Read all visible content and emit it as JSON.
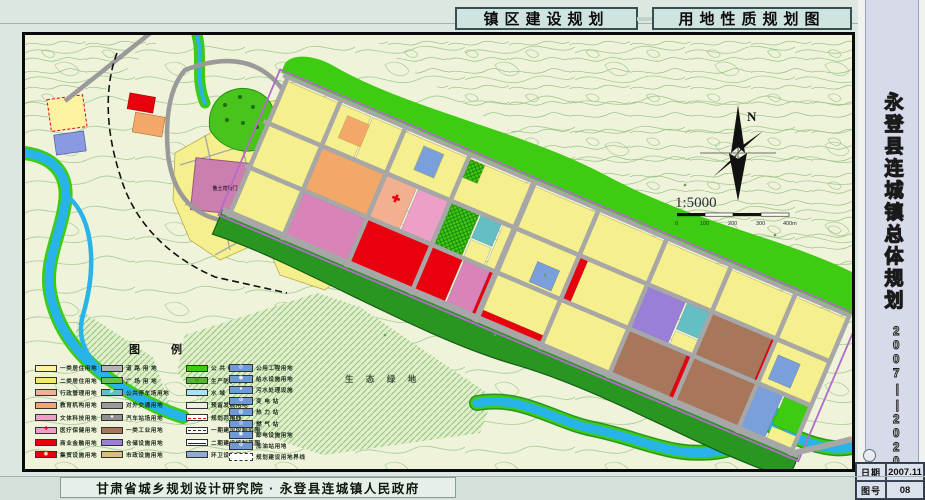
{
  "header": {
    "box1": "镇区建设规划",
    "box2": "用地性质规划图"
  },
  "sidebar": {
    "title": "永登县连城镇总体规划",
    "period": "2007∣∣2020"
  },
  "infobox": {
    "date_label": "日期",
    "date_value": "2007.11",
    "sheet_label": "图号",
    "sheet_value": "08"
  },
  "footer": {
    "credit": "甘肃省城乡规划设计研究院 · 永登县连城镇人民政府"
  },
  "map": {
    "labels": {
      "eco": "生 态 绿 地",
      "heritage": "鲁土司衙门"
    },
    "compass_n": "N",
    "scale_ratio": "1:5000",
    "scale_ticks": [
      "0",
      "100",
      "200",
      "300",
      "400m"
    ]
  },
  "legend": {
    "title": "图  例",
    "columns": [
      {
        "items": [
          {
            "label": "一类居住用地",
            "color": "#fdf3a0"
          },
          {
            "label": "二类居住用地",
            "color": "#f5e96a"
          },
          {
            "label": "行政管理用地",
            "color": "#f2b090"
          },
          {
            "label": "教育机构用地",
            "color": "#f3a869"
          },
          {
            "label": "文体科技用地",
            "color": "#ee9fc8"
          },
          {
            "label": "医疗保健用地",
            "color": "#ee9fc8",
            "sym": "✚",
            "symColor": "#e8000e"
          },
          {
            "label": "商业金融用地",
            "color": "#e8000e"
          },
          {
            "label": "集贸设施用地",
            "color": "#e8000e",
            "sym": "◉",
            "symColor": "#ffffff"
          }
        ]
      },
      {
        "items": [
          {
            "label": "道 路 用 地",
            "color": "#b4b4b4"
          },
          {
            "label": "广 场 用 地",
            "color": "#6abf4b"
          },
          {
            "label": "公共停车场用地",
            "color": "#63bfc4",
            "sym": "P",
            "symColor": "#ffffff"
          },
          {
            "label": "对外交通用地",
            "color": "#9a9a9a"
          },
          {
            "label": "汽车站场用地",
            "color": "#8f8f8f",
            "sym": "●",
            "symColor": "#ffffff"
          },
          {
            "label": "一类工业用地",
            "color": "#a8765a"
          },
          {
            "label": "仓储设施用地",
            "color": "#9a7fd8"
          },
          {
            "label": "市政设施用地",
            "color": "#d9bd83"
          }
        ]
      },
      {
        "items": [
          {
            "label": "公 共 绿 地",
            "color": "#3dcc12"
          },
          {
            "label": "生产防护绿地",
            "color": "#55b43c",
            "sym": "◎",
            "symColor": "#1d6e10"
          },
          {
            "label": "水  域",
            "color": "#a8e4f4"
          },
          {
            "label": "预留发展用地",
            "color": "#eeeee4"
          },
          {
            "label": "规划范围线",
            "cls": "line-red"
          },
          {
            "label": "一期建设控制范围",
            "cls": "line-one"
          },
          {
            "label": "二期建设控制范围",
            "cls": "line-two"
          },
          {
            "label": "环卫设施用地",
            "color": "#90aad8"
          }
        ]
      },
      {
        "items": [
          {
            "label": "公用工程用地",
            "sym": "◎",
            "symColor": "#ffffff"
          },
          {
            "label": "给水设施用地",
            "sym": "◉",
            "symColor": "#ffffff"
          },
          {
            "label": "污水处理设施",
            "sym": "●",
            "symColor": "#ffffff"
          },
          {
            "label": "变 电 站",
            "sym": "⊙",
            "symColor": "#ffffff"
          },
          {
            "label": "热 力 站",
            "sym": "◍",
            "symColor": "#ffffff"
          },
          {
            "label": "燃 气 站",
            "sym": "◎",
            "symColor": "#ffffff"
          },
          {
            "label": "邮电设施用地",
            "sym": "◉",
            "symColor": "#ffffff"
          },
          {
            "label": "加油站用地",
            "sym": "⊙",
            "symColor": "#ffffff"
          },
          {
            "label": "规划建设用地界线",
            "cls": "dashed-box"
          }
        ]
      }
    ]
  },
  "colors": {
    "residential_yellow": "#f6ef8d",
    "commercial_red": "#e8000e",
    "market_mauve": "#d884b8",
    "culture_pink": "#ee9fc8",
    "education_orange": "#f3a869",
    "industry_brown": "#a8765a",
    "warehouse_purple": "#9a7fd8",
    "utility_blue": "#6f9ad8",
    "road_gray": "#a7a7a7",
    "public_green": "#3dcc12",
    "protect_green": "#2a9622",
    "water_blue": "#28b4e8",
    "title_bg": "#cfe3e1",
    "sidebar_bg": "#d7dbe9"
  }
}
